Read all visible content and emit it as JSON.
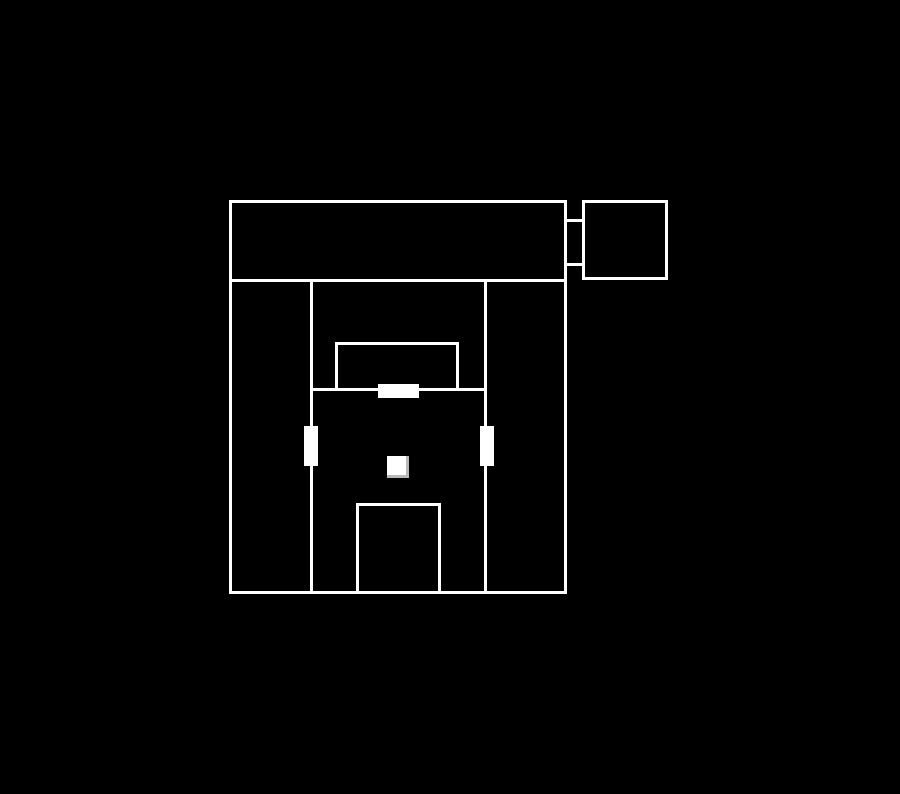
{
  "canvas": {
    "width": 900,
    "height": 794,
    "background_color": "#000000",
    "line_color": "#ffffff",
    "line_width": 3
  },
  "floorplan": {
    "description": "White-outline floor plan on black background: main building with top hall, detached annex room at top right connected by a short corridor, two interior vertical walls, an upper inner room, a lower inner room, three filled door markers and one small square object in the center room",
    "outlines": [
      {
        "name": "top-hall-room-outline",
        "x": 229,
        "y": 200,
        "w": 338,
        "h": 82
      },
      {
        "name": "annex-room-outline",
        "x": 582,
        "y": 200,
        "w": 86,
        "h": 80
      },
      {
        "name": "main-building-outline",
        "x": 229,
        "y": 279,
        "w": 338,
        "h": 315
      },
      {
        "name": "inner-room-upper-outline",
        "x": 335,
        "y": 342,
        "w": 124,
        "h": 49
      },
      {
        "name": "inner-room-lower-outline",
        "x": 356,
        "y": 503,
        "w": 85,
        "h": 91
      }
    ],
    "walls": [
      {
        "name": "interior-wall-left-vertical",
        "x": 310,
        "y": 281,
        "w": 3,
        "h": 311
      },
      {
        "name": "interior-wall-right-vertical",
        "x": 484,
        "y": 281,
        "w": 3,
        "h": 311
      },
      {
        "name": "interior-wall-horizontal",
        "x": 311,
        "y": 388,
        "w": 176,
        "h": 3
      },
      {
        "name": "corridor-wall-top",
        "x": 564,
        "y": 219,
        "w": 20,
        "h": 3
      },
      {
        "name": "corridor-wall-bottom",
        "x": 564,
        "y": 263,
        "w": 20,
        "h": 3
      }
    ],
    "doors": [
      {
        "name": "door-marker-top",
        "x": 378,
        "y": 384,
        "w": 41,
        "h": 14
      },
      {
        "name": "door-marker-left",
        "x": 304,
        "y": 426,
        "w": 14,
        "h": 40
      },
      {
        "name": "door-marker-right",
        "x": 480,
        "y": 426,
        "w": 14,
        "h": 40
      }
    ],
    "objects": [
      {
        "name": "center-square-object",
        "x": 387,
        "y": 456,
        "w": 22,
        "h": 22,
        "bevel": true
      }
    ]
  }
}
